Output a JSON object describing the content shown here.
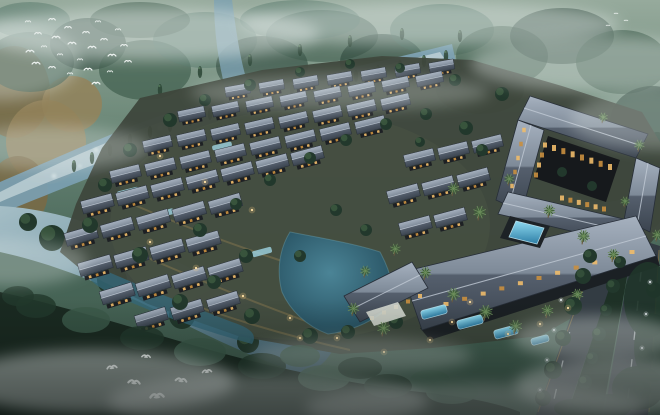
{
  "meta": {
    "description": "Dusk aerial architectural rendering of a lakeside resort village with traditional tiled-roof villas, a courtyard hotel with pools, winding river, misty forest and flying birds",
    "width": 660,
    "height": 415
  },
  "palette": {
    "fd": "#2c463a",
    "fm": "#3c5a4a",
    "ft": "#4e7263",
    "g1": "#7a6a44",
    "g2": "#93825a",
    "river_light": "#c6d6da",
    "river_mid": "#7ba0b2",
    "lake_rim": "#6fa3ae",
    "ground": "#3e473c",
    "ground_light": "#4a5344",
    "roof_edge": "#272e38",
    "ridge": "#c2cbd6",
    "wall": "#1d2024",
    "window": "#eebb6a",
    "window_deep": "#c98f3f",
    "tree_dark": "#22382c",
    "tree_light": "#4a6b4a",
    "palm": "#41603a",
    "palm_light": "#6d8f5c",
    "trunk": "#6a5a40",
    "stream": "#9fd4e2",
    "road": "#333c43",
    "road_dash": "#dde3e7",
    "road_edge": "#b89543",
    "median": "#1e3126",
    "bird": "#f2f6f4",
    "light_warm": "#ffd284",
    "light_core": "#ffe2a6",
    "light_cool": "#eef4f8",
    "pool_rim": "#bfe6f2",
    "facade": "#1b2024",
    "lobby_wall": "#d6dad2",
    "mist": "#e3eae8",
    "foam": "#e8f2f2"
  },
  "backdrop": {
    "golden": [
      [
        14,
        92,
        36,
        46
      ],
      [
        46,
        142,
        40,
        42
      ],
      [
        18,
        192,
        30,
        36
      ],
      [
        72,
        104,
        30,
        28
      ],
      [
        40,
        236,
        34,
        24
      ]
    ],
    "clumps": [
      [
        30,
        62,
        44,
        30,
        "fm",
        0.7
      ],
      [
        88,
        44,
        38,
        26,
        "fd",
        0.6
      ],
      [
        145,
        70,
        46,
        30,
        "fm",
        0.65
      ],
      [
        205,
        40,
        52,
        28,
        "ft",
        0.5
      ],
      [
        262,
        66,
        46,
        30,
        "fd",
        0.6
      ],
      [
        322,
        36,
        56,
        26,
        "fm",
        0.55
      ],
      [
        382,
        62,
        42,
        28,
        "fd",
        0.6
      ],
      [
        442,
        30,
        52,
        26,
        "ft",
        0.5
      ],
      [
        502,
        56,
        46,
        30,
        "fm",
        0.6
      ],
      [
        562,
        36,
        52,
        28,
        "fd",
        0.55
      ],
      [
        622,
        62,
        46,
        32,
        "fm",
        0.6
      ],
      [
        652,
        122,
        42,
        36,
        "fd",
        0.7
      ],
      [
        604,
        162,
        50,
        40,
        "fd",
        0.75
      ],
      [
        560,
        120,
        40,
        26,
        "fm",
        0.5
      ],
      [
        480,
        90,
        44,
        24,
        "fd",
        0.5
      ],
      [
        300,
        20,
        60,
        20,
        "ft",
        0.45
      ],
      [
        140,
        20,
        50,
        18,
        "fm",
        0.5
      ],
      [
        30,
        20,
        40,
        18,
        "ft",
        0.45
      ]
    ],
    "right_forest": [
      [
        657,
        162,
        16,
        30
      ],
      [
        651,
        202,
        14,
        26
      ]
    ]
  },
  "river": {
    "band": "M452,44 C404,56 340,70 300,80 C252,92 196,104 160,116 C118,130 56,158 0,182 L0,214 C48,194 120,166 170,146 C226,126 300,110 310,106 C370,94 430,76 456,62 Z",
    "inner": "M440,52 C360,72 280,90 210,108 C150,122 70,156 0,192 L0,202 C70,172 160,140 220,122 C290,104 380,84 444,58 Z",
    "branch": "M214,0 L232,0 C236,30 240,60 248,84 L226,92 C218,62 214,30 214,0 Z",
    "foam": [
      [
        96,
        150
      ],
      [
        130,
        138
      ],
      [
        160,
        128
      ],
      [
        196,
        116
      ],
      [
        226,
        104
      ],
      [
        262,
        96
      ],
      [
        300,
        86
      ],
      [
        340,
        76
      ],
      [
        120,
        158
      ],
      [
        80,
        166
      ],
      [
        54,
        176
      ],
      [
        150,
        146
      ],
      [
        250,
        112
      ],
      [
        370,
        70
      ]
    ],
    "conifers": [
      [
        150,
        132
      ],
      [
        170,
        126
      ],
      [
        190,
        120
      ],
      [
        210,
        114
      ],
      [
        230,
        108
      ],
      [
        252,
        102
      ],
      [
        272,
        96
      ],
      [
        292,
        91
      ],
      [
        312,
        86
      ],
      [
        334,
        81
      ],
      [
        356,
        76
      ],
      [
        378,
        71
      ],
      [
        400,
        66
      ],
      [
        424,
        61
      ],
      [
        446,
        56
      ],
      [
        130,
        140
      ],
      [
        110,
        150
      ],
      [
        92,
        158
      ],
      [
        74,
        166
      ],
      [
        250,
        60
      ],
      [
        300,
        50
      ],
      [
        350,
        41
      ],
      [
        402,
        34
      ],
      [
        460,
        36
      ],
      [
        200,
        72
      ],
      [
        160,
        90
      ]
    ]
  },
  "wetland": {
    "water": "M0,206 C44,208 92,222 136,242 C180,262 224,286 266,306 C298,320 322,332 336,342 C330,360 318,370 302,374 C258,360 212,338 168,316 C120,292 64,266 0,252 Z",
    "islands": [
      [
        52,
        238,
        13
      ],
      [
        112,
        280,
        15
      ],
      [
        182,
        316,
        13
      ],
      [
        248,
        342,
        11
      ],
      [
        28,
        222,
        9
      ]
    ]
  },
  "grounds": {
    "outline": "M140,98 L262,70 L382,56 L472,60 L562,86 L642,112 L660,142 L660,232 L600,302 L540,336 L432,348 L340,354 L238,336 L148,304 L84,272 L60,252 L76,204 L102,148 Z",
    "lit_paths": [
      "M148,258 Q250,302 342,334",
      "M118,198 Q225,245 330,276",
      "M180,300 Q260,330 350,350"
    ],
    "lake": "M290,232 C322,238 356,244 380,252 C392,274 396,294 388,308 C370,324 346,332 328,334 C306,326 290,310 282,292 C276,270 280,248 290,232 Z",
    "channel": "M86,262 C130,282 180,302 232,322 C250,328 258,334 252,344 C200,330 150,312 108,292 C92,284 80,272 86,262 Z",
    "streams": [
      [
        128,
        192,
        22,
        6,
        -14
      ],
      [
        222,
        146,
        20,
        5,
        -13
      ],
      [
        162,
        214,
        24,
        6,
        -15
      ],
      [
        298,
        122,
        18,
        5,
        -12
      ],
      [
        262,
        252,
        20,
        6,
        -15
      ]
    ]
  },
  "villas": {
    "rows": [
      {
        "x": 238,
        "y": 92,
        "n": 7,
        "dx": 34,
        "dy": -4,
        "a": -10,
        "s": 0.78
      },
      {
        "x": 192,
        "y": 116,
        "n": 8,
        "dx": 34,
        "dy": -5,
        "a": -12,
        "s": 0.84
      },
      {
        "x": 158,
        "y": 146,
        "n": 8,
        "dx": 34,
        "dy": -6,
        "a": -13,
        "s": 0.9
      },
      {
        "x": 126,
        "y": 176,
        "n": 8,
        "dx": 35,
        "dy": -7,
        "a": -14,
        "s": 0.95
      },
      {
        "x": 98,
        "y": 206,
        "n": 7,
        "dx": 35,
        "dy": -8,
        "a": -15,
        "s": 1
      },
      {
        "x": 420,
        "y": 160,
        "n": 3,
        "dx": 34,
        "dy": -7,
        "a": -14,
        "s": 0.95
      },
      {
        "x": 82,
        "y": 238,
        "n": 5,
        "dx": 36,
        "dy": -8,
        "a": -16,
        "s": 1.02
      },
      {
        "x": 404,
        "y": 196,
        "n": 3,
        "dx": 35,
        "dy": -8,
        "a": -15,
        "s": 1
      },
      {
        "x": 96,
        "y": 268,
        "n": 4,
        "dx": 36,
        "dy": -8,
        "a": -16,
        "s": 1.05
      },
      {
        "x": 416,
        "y": 228,
        "n": 2,
        "dx": 35,
        "dy": -8,
        "a": -15,
        "s": 1
      },
      {
        "x": 118,
        "y": 296,
        "n": 4,
        "dx": 36,
        "dy": -8,
        "a": -17,
        "s": 1.05
      },
      {
        "x": 152,
        "y": 320,
        "n": 3,
        "dx": 36,
        "dy": -8,
        "a": -17,
        "s": 1
      }
    ]
  },
  "trees": [
    [
      170,
      120,
      7
    ],
    [
      205,
      100,
      6
    ],
    [
      250,
      85,
      6
    ],
    [
      300,
      72,
      5
    ],
    [
      350,
      64,
      5
    ],
    [
      400,
      68,
      5
    ],
    [
      455,
      80,
      6
    ],
    [
      502,
      94,
      7
    ],
    [
      130,
      150,
      7
    ],
    [
      105,
      185,
      7
    ],
    [
      90,
      225,
      8
    ],
    [
      140,
      255,
      8
    ],
    [
      200,
      230,
      7
    ],
    [
      236,
      204,
      6
    ],
    [
      270,
      180,
      6
    ],
    [
      310,
      158,
      6
    ],
    [
      346,
      140,
      6
    ],
    [
      386,
      124,
      6
    ],
    [
      426,
      114,
      6
    ],
    [
      466,
      128,
      7
    ],
    [
      246,
      256,
      7
    ],
    [
      214,
      282,
      7
    ],
    [
      180,
      302,
      8
    ],
    [
      252,
      316,
      8
    ],
    [
      310,
      336,
      8
    ],
    [
      348,
      332,
      7
    ],
    [
      396,
      322,
      7
    ],
    [
      300,
      256,
      6
    ],
    [
      366,
      230,
      6
    ],
    [
      336,
      210,
      6
    ],
    [
      482,
      150,
      6
    ],
    [
      520,
      170,
      6
    ],
    [
      420,
      142,
      5
    ]
  ],
  "hotel": {
    "roofs": [
      {
        "pts": "530,96 648,134 636,158 518,120",
        "ridge": [
          524,
          108,
          642,
          146
        ]
      },
      {
        "pts": "636,158 660,168 650,232 624,220",
        "ridge": [
          648,
          163,
          637,
          226
        ]
      },
      {
        "pts": "518,120 544,130 522,212 496,200",
        "ridge": [
          531,
          125,
          509,
          206
        ]
      },
      {
        "pts": "508,192 628,220 618,242 498,214",
        "ridge": [
          503,
          203,
          623,
          231
        ]
      }
    ],
    "courtyard": {
      "pts": "548,136 620,160 606,202 534,178",
      "plants": [
        [
          562,
          172,
          5
        ],
        [
          592,
          186,
          5
        ]
      ]
    },
    "main_roofs": [
      {
        "pts": "402,272 636,216 656,256 422,330",
        "ridge": [
          412,
          301,
          646,
          236
        ]
      },
      {
        "pts": "344,296 412,262 428,288 360,322",
        "ridge": [
          352,
          309,
          420,
          275
        ]
      }
    ],
    "facade": "420,328 656,254 660,266 430,340",
    "pool_court": "510,216 550,226 540,248 500,238",
    "pool": "516,221 544,228 537,244 509,237",
    "window_strips": [
      {
        "x1": 554,
        "y1": 148,
        "x2": 610,
        "y2": 167,
        "n": 7,
        "w": 4,
        "h": 6
      },
      {
        "x1": 545,
        "y1": 145,
        "x2": 536,
        "y2": 175,
        "n": 4,
        "w": 4,
        "h": 5
      },
      {
        "x1": 562,
        "y1": 198,
        "x2": 604,
        "y2": 209,
        "n": 6,
        "w": 4,
        "h": 5
      },
      {
        "x1": 446,
        "y1": 304,
        "x2": 632,
        "y2": 252,
        "n": 11,
        "w": 5,
        "h": 4
      },
      {
        "x1": 524,
        "y1": 130,
        "x2": 512,
        "y2": 186,
        "n": 5,
        "w": 3.5,
        "h": 4.5
      },
      {
        "x1": 372,
        "y1": 318,
        "x2": 420,
        "y2": 296,
        "n": 5,
        "w": 4,
        "h": 4
      }
    ],
    "lobby_wall": "366,312 398,302 406,316 374,326",
    "terrace_pools": [
      [
        434,
        312,
        26,
        9,
        -15
      ],
      [
        470,
        322,
        26,
        9,
        -15
      ],
      [
        506,
        332,
        24,
        9,
        -15
      ],
      [
        540,
        340,
        18,
        7,
        -15
      ]
    ]
  },
  "palms": [
    [
      452,
      192,
      1
    ],
    [
      478,
      216,
      1.1
    ],
    [
      508,
      182,
      0.9
    ],
    [
      548,
      214,
      1
    ],
    [
      582,
      240,
      1.1
    ],
    [
      612,
      258,
      1
    ],
    [
      424,
      276,
      1
    ],
    [
      452,
      298,
      1.1
    ],
    [
      484,
      316,
      1.2
    ],
    [
      514,
      330,
      1.1
    ],
    [
      546,
      314,
      1
    ],
    [
      576,
      298,
      1
    ],
    [
      352,
      312,
      1
    ],
    [
      382,
      332,
      1.1
    ],
    [
      638,
      148,
      0.9
    ],
    [
      656,
      238,
      0.9
    ],
    [
      394,
      252,
      0.9
    ],
    [
      364,
      274,
      0.9
    ],
    [
      602,
      120,
      0.8
    ],
    [
      624,
      204,
      0.8
    ]
  ],
  "road": {
    "left": "596,246 622,254 566,415 536,415",
    "right": "634,238 660,246 648,415 604,415",
    "median": "621,253 633,244 602,415 567,415",
    "median_trees": [
      [
        620,
        262,
        6
      ],
      [
        613,
        286,
        7
      ],
      [
        606,
        310,
        6
      ],
      [
        599,
        334,
        7
      ],
      [
        592,
        358,
        6
      ],
      [
        585,
        382,
        7
      ],
      [
        578,
        404,
        6
      ]
    ],
    "side_trees": [
      [
        583,
        276,
        8
      ],
      [
        573,
        306,
        9
      ],
      [
        563,
        338,
        8
      ],
      [
        553,
        370,
        9
      ],
      [
        543,
        398,
        8
      ],
      [
        590,
        256,
        7
      ],
      [
        654,
        290,
        8
      ],
      [
        650,
        322,
        9
      ],
      [
        646,
        356,
        8
      ],
      [
        642,
        390,
        9
      ]
    ],
    "dash_lines": [
      {
        "x1": 585,
        "y1": 266,
        "x2": 552,
        "y2": 408,
        "n": 5
      },
      {
        "x1": 642,
        "y1": 262,
        "x2": 627,
        "y2": 408,
        "n": 5
      }
    ],
    "edge_lines": [
      [
        597,
        250,
        538,
        412
      ],
      [
        659,
        250,
        649,
        412
      ]
    ],
    "lights": [
      [
        561,
        300
      ],
      [
        554,
        330
      ],
      [
        547,
        360
      ],
      [
        540,
        390
      ],
      [
        650,
        282
      ],
      [
        646,
        314
      ],
      [
        642,
        348
      ]
    ],
    "car": [
      600,
      334
    ]
  },
  "bottom": {
    "band": "M0,292 C56,304 120,324 196,346 C272,368 352,384 420,392 C470,397 500,404 520,412 L520,415 L0,415 Z",
    "clumps": [
      [
        36,
        306,
        20,
        12
      ],
      [
        86,
        320,
        24,
        13
      ],
      [
        142,
        338,
        22,
        12
      ],
      [
        200,
        352,
        26,
        14
      ],
      [
        262,
        366,
        24,
        13
      ],
      [
        324,
        378,
        26,
        13
      ],
      [
        388,
        386,
        24,
        12
      ],
      [
        452,
        392,
        26,
        12
      ],
      [
        18,
        296,
        16,
        10
      ],
      [
        300,
        356,
        20,
        11
      ],
      [
        360,
        368,
        22,
        11
      ],
      [
        430,
        380,
        20,
        10
      ]
    ],
    "right_clumps": [
      [
        648,
        300,
        24,
        38
      ],
      [
        654,
        348,
        20,
        34
      ],
      [
        638,
        388,
        26,
        22
      ],
      [
        610,
        406,
        22,
        12
      ],
      [
        572,
        408,
        18,
        9
      ]
    ]
  },
  "birds": {
    "flock": [
      [
        28,
        22
      ],
      [
        38,
        34
      ],
      [
        30,
        52
      ],
      [
        44,
        47
      ],
      [
        52,
        20
      ],
      [
        56,
        38
      ],
      [
        60,
        55
      ],
      [
        68,
        28
      ],
      [
        72,
        44
      ],
      [
        80,
        60
      ],
      [
        86,
        33
      ],
      [
        92,
        48
      ],
      [
        98,
        22
      ],
      [
        104,
        40
      ],
      [
        112,
        56
      ],
      [
        118,
        30
      ],
      [
        124,
        46
      ],
      [
        88,
        70
      ],
      [
        70,
        74
      ],
      [
        52,
        68
      ],
      [
        36,
        64
      ],
      [
        110,
        72
      ],
      [
        128,
        62
      ],
      [
        96,
        84
      ]
    ],
    "small": [
      [
        616,
        14
      ],
      [
        626,
        21
      ],
      [
        608,
        26
      ]
    ],
    "egrets": [
      [
        112,
        368,
        1.6,
        -8
      ],
      [
        134,
        383,
        1.9,
        6
      ],
      [
        157,
        397,
        2.2,
        -4
      ],
      [
        181,
        381,
        1.8,
        8
      ],
      [
        207,
        372,
        1.5,
        -6
      ],
      [
        146,
        357,
        1.4,
        4
      ]
    ]
  },
  "lights": [
    [
      150,
      242
    ],
    [
      196,
      268
    ],
    [
      243,
      296
    ],
    [
      290,
      318
    ],
    [
      337,
      338
    ],
    [
      384,
      352
    ],
    [
      430,
      340
    ],
    [
      452,
      322
    ],
    [
      470,
      302
    ],
    [
      508,
      334
    ],
    [
      540,
      324
    ],
    [
      568,
      308
    ],
    [
      252,
      210
    ],
    [
      205,
      182
    ],
    [
      160,
      156
    ],
    [
      300,
      338
    ]
  ],
  "mist": [
    [
      150,
      34,
      170,
      26,
      0.5
    ],
    [
      430,
      24,
      190,
      22,
      0.45
    ],
    [
      600,
      64,
      130,
      28,
      0.4
    ],
    [
      50,
      148,
      100,
      22,
      0.32
    ],
    [
      340,
      92,
      150,
      18,
      0.28
    ],
    [
      95,
      382,
      140,
      32,
      0.55
    ],
    [
      268,
      402,
      160,
      28,
      0.45
    ],
    [
      475,
      408,
      170,
      24,
      0.4
    ],
    [
      625,
      386,
      110,
      28,
      0.5
    ],
    [
      598,
      338,
      85,
      22,
      0.42
    ],
    [
      362,
      356,
      110,
      18,
      0.3
    ],
    [
      8,
      262,
      80,
      24,
      0.3
    ],
    [
      660,
      120,
      90,
      30,
      0.3
    ],
    [
      0,
      60,
      80,
      40,
      0.35
    ]
  ]
}
